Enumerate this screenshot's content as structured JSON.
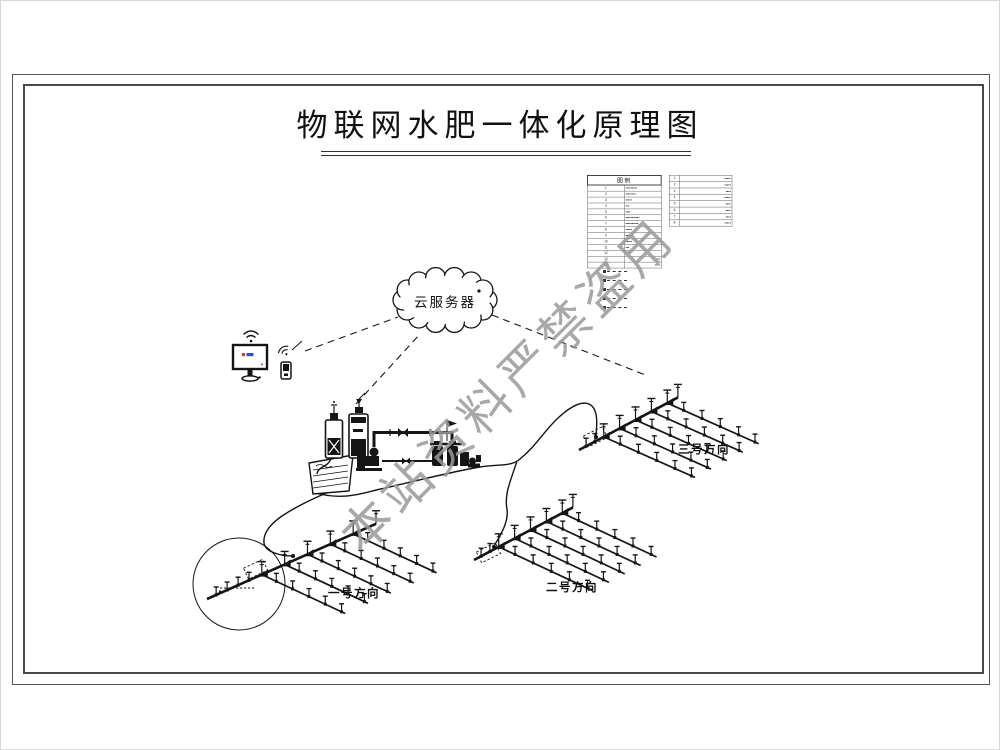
{
  "title": "物联网水肥一体化原理图",
  "watermark": "本站资料严禁盗用",
  "cloud": {
    "label": "云服务器",
    "icon": "cloud-icon"
  },
  "devices": {
    "monitor_icon": "desktop-monitor-with-wifi",
    "mobile_icon": "mobile-terminal-with-wifi"
  },
  "station": {
    "icons": [
      "fertilizer-tank-icon",
      "dosing-tank-icon",
      "water-pool-icon",
      "pump-icon",
      "pipe-valve-icon",
      "filter-station-icon",
      "antenna-flag-icon"
    ]
  },
  "legend": {
    "header": "图例",
    "left_rows": [
      {
        "no": "1",
        "text": "▪▪▪▪▪▪▪▪▪",
        "align": "left"
      },
      {
        "no": "2",
        "text": "▪▪▪▪▪▪▪▪",
        "align": "left"
      },
      {
        "no": "3",
        "text": "▪▪▪▪▪",
        "align": "left"
      },
      {
        "no": "4",
        "text": "▪▪▪",
        "align": "left"
      },
      {
        "no": "5",
        "text": "▪▪▪▪",
        "align": "left"
      },
      {
        "no": "6",
        "text": "▪▪▪▪▪▪▪▪▪▪▪",
        "align": "left"
      },
      {
        "no": "7",
        "text": "▪▪▪▪▪▪▪▪▪▪",
        "align": "left"
      },
      {
        "no": "8",
        "text": "▪▪▪▪▪",
        "align": "left"
      },
      {
        "no": "9",
        "text": "▪▪▪▪▪▪",
        "align": "left"
      },
      {
        "no": "10",
        "text": "▪▪▪▪▪",
        "align": "left"
      },
      {
        "no": "11",
        "text": "▪▪▪",
        "align": "left"
      },
      {
        "no": "12",
        "text": "▪▪▪▪",
        "align": "left"
      },
      {
        "no": "13",
        "text": "▪▪▪",
        "align": "right"
      },
      {
        "no": "14",
        "text": "▪▪▪▪",
        "align": "right"
      }
    ],
    "right_rows": [
      {
        "no": "1",
        "text": "▪▪▪▪▪"
      },
      {
        "no": "2",
        "text": "▪▪▪▪▪"
      },
      {
        "no": "3",
        "text": "▪▪▪▪"
      },
      {
        "no": "4",
        "text": "▪▪▪▪▪"
      },
      {
        "no": "5",
        "text": "▪▪▪▪"
      },
      {
        "no": "6",
        "text": "▪▪▪▪"
      },
      {
        "no": "7",
        "text": "▪▪▪▪"
      },
      {
        "no": "8",
        "text": "▪▪▪▪▪"
      }
    ],
    "notes": [
      "dashed-leader",
      "dashed-leader",
      "dashed-leader",
      "dashed-leader",
      "dashed-leader"
    ]
  },
  "fields": [
    {
      "name": "field-1",
      "label": "一号方向"
    },
    {
      "name": "field-2",
      "label": "二号方向"
    },
    {
      "name": "field-3",
      "label": "三号方向"
    }
  ],
  "colors": {
    "ink": "#151515",
    "frame": "#4a4a4a",
    "watermark_gray": "#9a9a9a",
    "screen_blue": "#2b4fd0",
    "screen_red": "#d03b2b"
  }
}
